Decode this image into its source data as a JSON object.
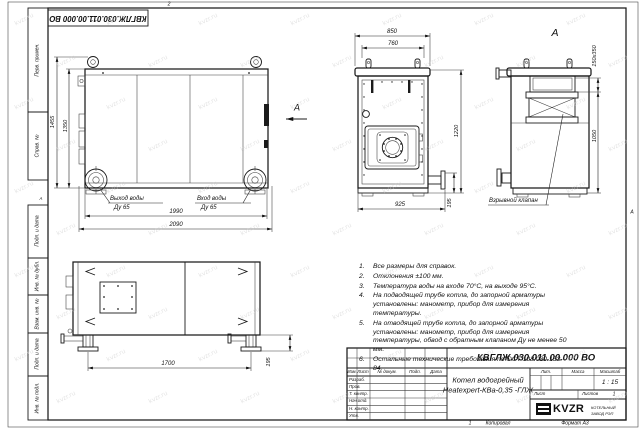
{
  "colors": {
    "line": "#1b1b1b",
    "paper": "#ffffff",
    "watermark": "#cccccc"
  },
  "watermark": "kvzr.ru",
  "sheet": {
    "stamp_top_rotated": "КВГЛЖ.030.011.00.000 ВО",
    "zones": {
      "top": "2",
      "bottom": "1",
      "right": "А",
      "left": "А"
    },
    "sidebar": {
      "perv_primen": "Перв. примен.",
      "sprav_no": "Справ. №",
      "podp_data_1": "Подп. и дата",
      "inv_dubl": "Инв. № дубл.",
      "vzam_inv": "Взам. инв. №",
      "podp_data_2": "Подп. и дата",
      "inv_podl": "Инв. № подл."
    },
    "footer": {
      "kopiroval": "Копировал",
      "format": "Формат А3"
    }
  },
  "views": {
    "side": {
      "view_arrow_label": "А",
      "dim_height_overall": "1455",
      "dim_height_body": "1350",
      "dim_length_body": "1990",
      "dim_length_overall": "2090",
      "outlet": {
        "line1": "Выход воды",
        "line2": "Ду 65"
      },
      "inlet": {
        "line1": "Вход воды",
        "line2": "Ду 65"
      }
    },
    "front": {
      "dim_width_overall": "850",
      "dim_width_top": "760",
      "dim_height": "1220",
      "dim_flange_height": "195",
      "dim_width_base": "925"
    },
    "rear": {
      "title": "А",
      "dim_flue": "150х350",
      "dim_height": "1050",
      "valve_label": "Взрывной клапан"
    },
    "plan": {
      "dim_legs_span": "1700",
      "dim_leg_height": "195"
    }
  },
  "notes": [
    {
      "num": "1.",
      "text": "Все размеры для справок."
    },
    {
      "num": "2.",
      "text": "Отклонения ±100 мм."
    },
    {
      "num": "3.",
      "text": "Температура воды на входе 70°С, на выходе 95°С."
    },
    {
      "num": "4.",
      "text": "На подводящей трубе котла, до запорной арматуры установлены: манометр, прибор для измерения температуры."
    },
    {
      "num": "5.",
      "text": "На отводящей трубе котла, до запорной арматуры установлены: манометр, прибор для измерения температуры, обвод с обратным клапаном Ду не менее 50 мм."
    },
    {
      "num": "6.",
      "text": "Остальные технические требования по ОСТ 108.030.133-84."
    }
  ],
  "title_block": {
    "doc_number": "КВГЛЖ.030.011.00.000 ВО",
    "product_line1": "Котел водогрейный",
    "product_line2": "Heatexpert-КВа-0,35 -ГЛЖ",
    "col_izm": "Изм.",
    "col_list": "Лист",
    "col_doc": "№ докум.",
    "col_podp": "Подп.",
    "col_data": "Дата",
    "row_razrab": "Разраб.",
    "row_prov": "Пров.",
    "row_tkontr": "Т. контр.",
    "row_nachotd": "Нач.отд.",
    "row_nkontr": "Н. контр.",
    "row_utv": "Утв.",
    "lit_label": "Лит.",
    "massa_label": "Масса",
    "masshtab_label": "Масштаб",
    "scale_value": "1 : 15",
    "list_label": "Лист",
    "listov_label": "Листов",
    "listov_value": "1",
    "logo_text": "KVZR",
    "company_line1": "КОТЕЛЬНЫЙ",
    "company_line2": "ЗАВОД РЭП"
  }
}
